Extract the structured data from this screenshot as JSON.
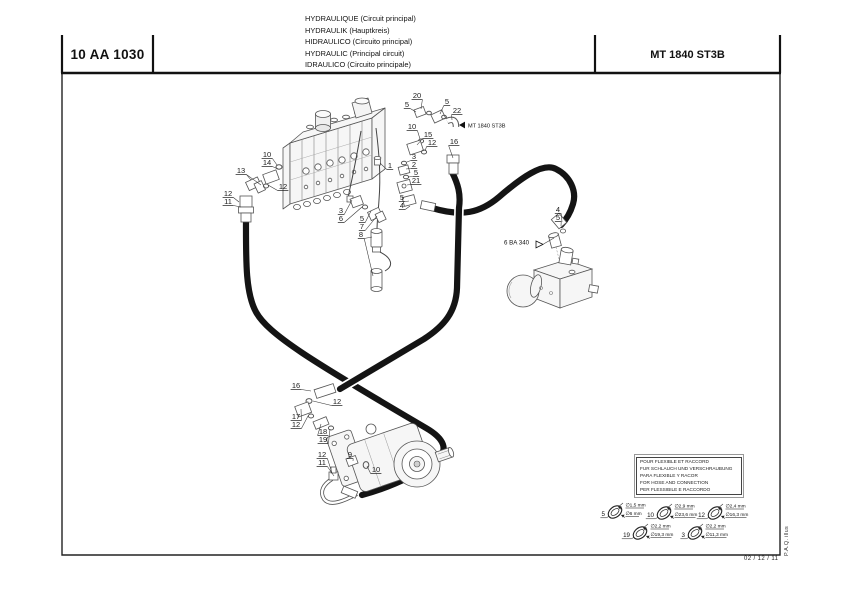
{
  "header": {
    "code": "10 AA 1030",
    "model": "MT 1840 ST3B",
    "titles": [
      "HYDRAULIQUE (Circuit principal)",
      "HYDRAULIK (Hauptkreis)",
      "HIDRAULICO (Circuito principal)",
      "HYDRAULIC (Principal circuit)",
      "IDRAULICO (Circuito principale)"
    ]
  },
  "annotations": {
    "mt_ref": "MT 1840 ST3B",
    "ba_ref": "6 BA 340"
  },
  "legend": {
    "lines": [
      "POUR FLEXIBLE ET RACCORD",
      "FUR SCHLAUCH UND VERSCHRAUBUNG",
      "PARA FLEXIBLE Y RACOR",
      "FOR HOSE AND CONNECTION",
      "PER FLESSIBILE E RACCORDO"
    ]
  },
  "footer": {
    "date": "02 / 12 / 11",
    "credit": "P.A.Q.  illus"
  },
  "diagram": {
    "callouts": [
      {
        "t": "20",
        "x": 417,
        "y": 97,
        "to": [
          [
            421,
            109
          ]
        ]
      },
      {
        "t": "5",
        "x": 407,
        "y": 106,
        "to": [
          [
            416,
            112
          ]
        ]
      },
      {
        "t": "5",
        "x": 447,
        "y": 103,
        "to": [
          [
            440,
            114
          ]
        ]
      },
      {
        "t": "22",
        "x": 457,
        "y": 112,
        "to": [
          [
            452,
            120
          ]
        ]
      },
      {
        "t": "10",
        "x": 412,
        "y": 128,
        "to": [
          [
            420,
            139
          ]
        ]
      },
      {
        "t": "15",
        "x": 428,
        "y": 136,
        "to": [
          [
            417,
            145
          ]
        ]
      },
      {
        "t": "12",
        "x": 432,
        "y": 144,
        "to": [
          [
            425,
            151
          ]
        ]
      },
      {
        "t": "16",
        "x": 454,
        "y": 143,
        "to": [
          [
            453,
            158
          ]
        ]
      },
      {
        "t": "1",
        "x": 390,
        "y": 167,
        "to": [
          [
            380,
            163
          ]
        ]
      },
      {
        "t": "3",
        "x": 414,
        "y": 158,
        "to": [
          [
            407,
            162
          ]
        ]
      },
      {
        "t": "2",
        "x": 414,
        "y": 166,
        "to": [
          [
            406,
            169
          ]
        ]
      },
      {
        "t": "5",
        "x": 416,
        "y": 174,
        "to": [
          [
            408,
            177
          ]
        ]
      },
      {
        "t": "21",
        "x": 416,
        "y": 182,
        "to": [
          [
            407,
            185
          ]
        ]
      },
      {
        "t": "5",
        "x": 402,
        "y": 199,
        "to": [
          [
            409,
            201
          ]
        ]
      },
      {
        "t": "4",
        "x": 402,
        "y": 207,
        "to": [
          [
            410,
            206
          ]
        ]
      },
      {
        "t": "10",
        "x": 267,
        "y": 156,
        "to": [
          [
            277,
            165
          ]
        ]
      },
      {
        "t": "14",
        "x": 267,
        "y": 164,
        "to": [
          [
            278,
            169
          ]
        ]
      },
      {
        "t": "13",
        "x": 241,
        "y": 172,
        "to": [
          [
            251,
            180
          ],
          [
            261,
            185
          ]
        ]
      },
      {
        "t": "12",
        "x": 283,
        "y": 188,
        "to": [
          [
            268,
            185
          ]
        ]
      },
      {
        "t": "12",
        "x": 228,
        "y": 195,
        "to": [
          [
            239,
            202
          ]
        ]
      },
      {
        "t": "11",
        "x": 228,
        "y": 203,
        "to": [
          [
            241,
            207
          ]
        ]
      },
      {
        "t": "3",
        "x": 341,
        "y": 212,
        "to": [
          [
            352,
            200
          ]
        ]
      },
      {
        "t": "6",
        "x": 341,
        "y": 220,
        "to": [
          [
            362,
            207
          ]
        ]
      },
      {
        "t": "5",
        "x": 362,
        "y": 220,
        "to": [
          [
            371,
            211
          ]
        ]
      },
      {
        "t": "7",
        "x": 362,
        "y": 228,
        "to": [
          [
            377,
            216
          ]
        ]
      },
      {
        "t": "8",
        "x": 361,
        "y": 236,
        "to": [
          [
            372,
            237
          ],
          [
            373,
            276
          ]
        ]
      },
      {
        "t": "4",
        "x": 558,
        "y": 211,
        "to": [
          [
            562,
            222
          ]
        ]
      },
      {
        "t": "5",
        "x": 558,
        "y": 219,
        "to": [
          [
            561,
            226
          ]
        ]
      },
      {
        "t": "16",
        "x": 296,
        "y": 387,
        "to": [
          [
            311,
            391
          ]
        ]
      },
      {
        "t": "12",
        "x": 337,
        "y": 403,
        "to": [
          [
            313,
            401
          ]
        ]
      },
      {
        "t": "17",
        "x": 296,
        "y": 418,
        "to": [
          [
            301,
            409
          ]
        ]
      },
      {
        "t": "12",
        "x": 296,
        "y": 426,
        "to": [
          [
            308,
            416
          ]
        ]
      },
      {
        "t": "18",
        "x": 323,
        "y": 433,
        "to": [
          [
            321,
            424
          ]
        ]
      },
      {
        "t": "19",
        "x": 323,
        "y": 441,
        "to": [
          [
            330,
            429
          ]
        ]
      },
      {
        "t": "12",
        "x": 322,
        "y": 456,
        "to": [
          [
            332,
            473
          ]
        ]
      },
      {
        "t": "11",
        "x": 322,
        "y": 464,
        "to": [
          [
            334,
            476
          ]
        ]
      },
      {
        "t": "9",
        "x": 350,
        "y": 456,
        "to": [
          [
            353,
            461
          ]
        ]
      },
      {
        "t": "10",
        "x": 376,
        "y": 471,
        "to": [
          [
            367,
            466
          ]
        ]
      }
    ]
  },
  "measurements": {
    "items": [
      {
        "ref": "5",
        "d1": "∅1,5 mm",
        "d2": "∅6 mm",
        "x": 615,
        "y": 512
      },
      {
        "ref": "10",
        "d1": "∅2,9 mm",
        "d2": "∅23,6 mm",
        "x": 664,
        "y": 513
      },
      {
        "ref": "12",
        "d1": "∅2,4 mm",
        "d2": "∅16,3 mm",
        "x": 715,
        "y": 513
      },
      {
        "ref": "19",
        "d1": "∅2,2 mm",
        "d2": "∅19,3 mm",
        "x": 640,
        "y": 533
      },
      {
        "ref": "3",
        "d1": "∅2,2 mm",
        "d2": "∅11,3 mm",
        "x": 695,
        "y": 533
      }
    ]
  }
}
